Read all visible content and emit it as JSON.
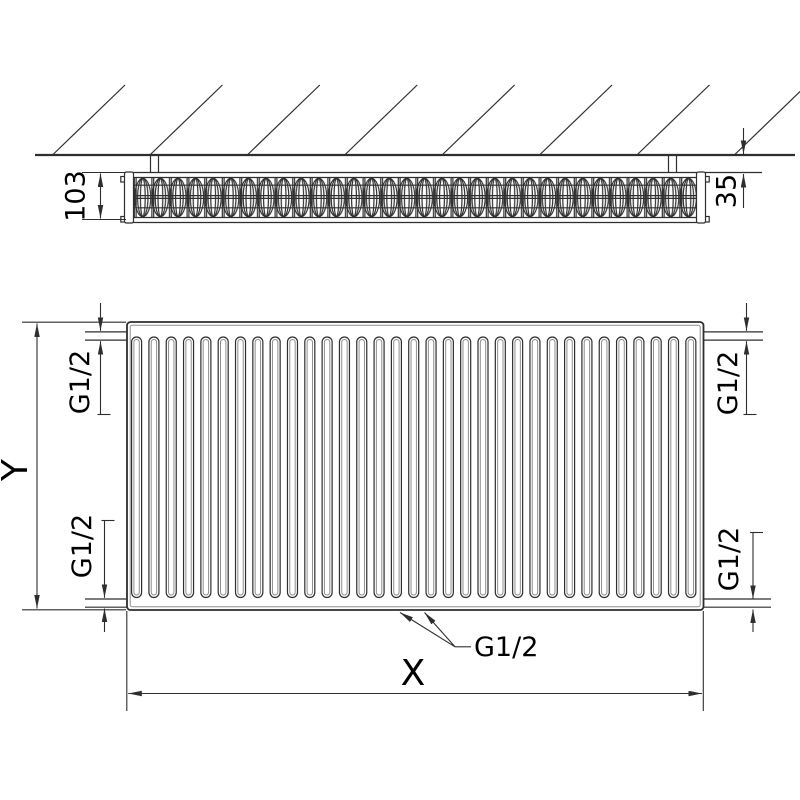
{
  "colors": {
    "line": "#2e2e2e",
    "line_light": "#8f8f8f",
    "text": "#000000",
    "background": "#ffffff"
  },
  "top_view": {
    "depth_label": "103",
    "wall_clearance_label": "35"
  },
  "front_view": {
    "height_label": "Y",
    "width_label": "X",
    "connections": {
      "top_left": "G1/2",
      "top_right": "G1/2",
      "bottom_left": "G1/2",
      "bottom_right": "G1/2",
      "bottom_center": "G1/2"
    }
  },
  "pattern": {
    "front_channel_count": 33,
    "fin_cell_count": 32,
    "hatch_line_count": 8
  }
}
